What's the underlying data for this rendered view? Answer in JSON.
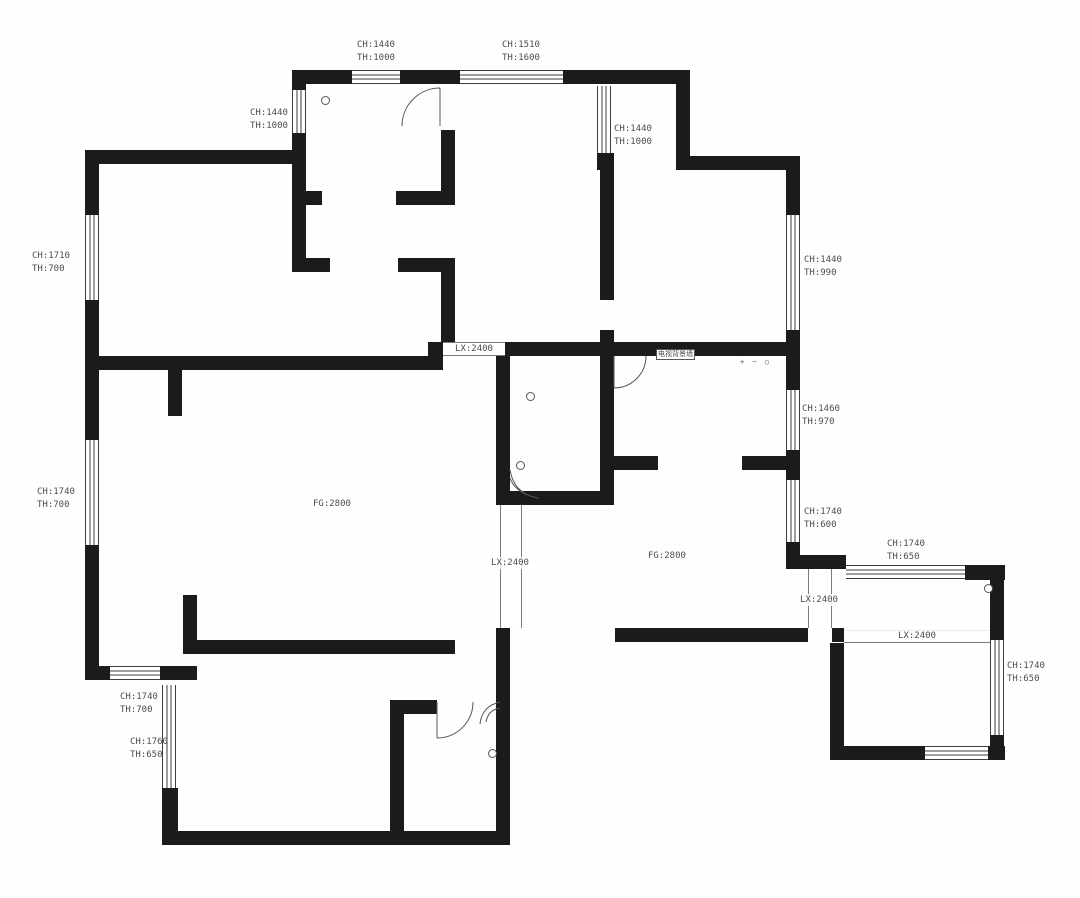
{
  "document": {
    "type": "apartment-floor-plan",
    "units_note": "mm"
  },
  "colors": {
    "wall": "#1b1b1b",
    "line": "#555555",
    "text": "#4d4d4d",
    "background": "#fefefe"
  },
  "annotations": [
    {
      "id": "win-top-1",
      "text": "CH:1440\nTH:1000"
    },
    {
      "id": "win-top-2",
      "text": "CH:1510\nTH:1600"
    },
    {
      "id": "win-upper-left",
      "text": "CH:1440\nTH:1000"
    },
    {
      "id": "win-nook",
      "text": "CH:1440\nTH:1000"
    },
    {
      "id": "win-left-1",
      "text": "CH:1710\nTH:700"
    },
    {
      "id": "win-right-1",
      "text": "CH:1440\nTH:990"
    },
    {
      "id": "win-right-2",
      "text": "CH:1460\nTH:970"
    },
    {
      "id": "win-left-2",
      "text": "CH:1740\nTH:700"
    },
    {
      "id": "win-right-3",
      "text": "CH:1740\nTH:600"
    },
    {
      "id": "win-br-top",
      "text": "CH:1740\nTH:650"
    },
    {
      "id": "win-br-right",
      "text": "CH:1740\nTH:650"
    },
    {
      "id": "win-bl-horiz",
      "text": "CH:1740\nTH:700"
    },
    {
      "id": "win-bl-vert",
      "text": "CH:1760\nTH:650"
    },
    {
      "id": "opening-hall",
      "text": "LX:2400"
    },
    {
      "id": "opening-left",
      "text": "LX:2400"
    },
    {
      "id": "opening-right",
      "text": "LX:2400"
    },
    {
      "id": "opening-balcony",
      "text": "LX:2400"
    },
    {
      "id": "room-height-left",
      "text": "FG:2800"
    },
    {
      "id": "room-height-right",
      "text": "FG:2800"
    },
    {
      "id": "tv-wall-tag",
      "text": "电视背景墙"
    },
    {
      "id": "outlet-symbols",
      "text": "+ ~ ○"
    }
  ]
}
